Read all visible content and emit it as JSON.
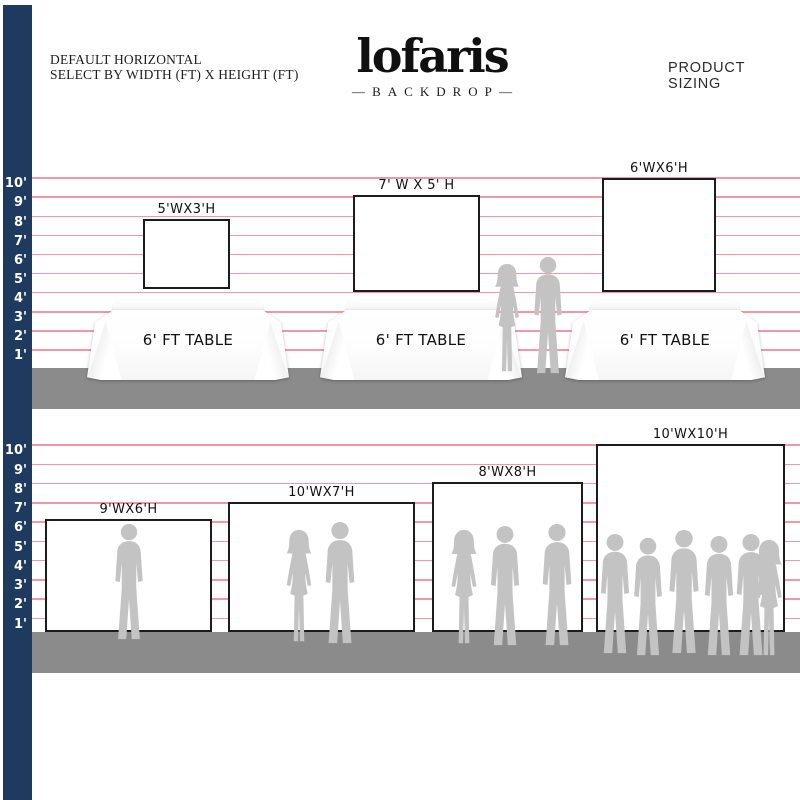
{
  "header": {
    "title_line1": "DEFAULT HORIZONTAL",
    "title_line2": "SELECT BY WIDTH (FT) X HEIGHT (FT)",
    "product_sizing": "PRODUCT SIZING"
  },
  "logo": {
    "brand": "lofaris",
    "tagline": "BACKDROP"
  },
  "ruler_labels": [
    "10'",
    "9'",
    "8'",
    "7'",
    "6'",
    "5'",
    "4'",
    "3'",
    "2'",
    "1'"
  ],
  "top_row": {
    "backdrops": [
      {
        "size_label": "5'WX3'H"
      },
      {
        "size_label": "7' W X 5' H"
      },
      {
        "size_label": "6'WX6'H"
      }
    ],
    "table_label": "6' FT TABLE"
  },
  "bottom_row": {
    "backdrops": [
      {
        "size_label": "9'WX6'H"
      },
      {
        "size_label": "10'WX7'H"
      },
      {
        "size_label": "8'WX8'H"
      },
      {
        "size_label": "10'WX10'H"
      }
    ]
  },
  "colors": {
    "ruler_bar": "#1e3a5f",
    "grid_line": "#ee7d95",
    "floor": "#8b8b8b",
    "silhouette": "#c3c3c3",
    "backdrop_border": "#1c1c1c"
  }
}
